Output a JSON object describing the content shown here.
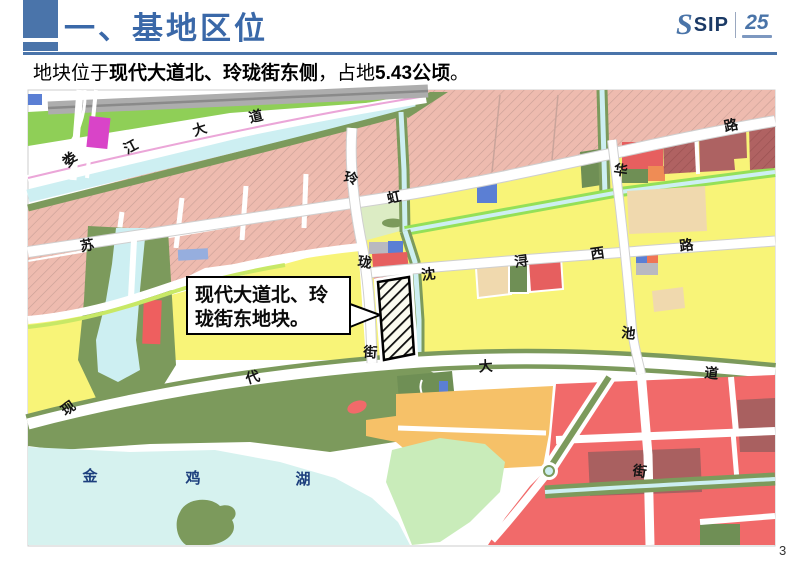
{
  "header": {
    "title": "一、基地区位",
    "logo": {
      "s": "S",
      "text": "SIP",
      "anniversary": "25"
    }
  },
  "subtitle": {
    "prefix": "地块位于",
    "highlight1": "现代大道北、玲珑街东侧",
    "middle": "，占地",
    "highlight2": "5.43公顷",
    "suffix": "。"
  },
  "map": {
    "callout": {
      "line1": "现代大道北、玲",
      "line2": "珑街东地块。"
    },
    "lake": {
      "char1": "金",
      "char2": "鸡",
      "char3": "湖"
    },
    "roads": {
      "loujiang": [
        "娄",
        "江",
        "大",
        "道"
      ],
      "suhong": [
        "苏",
        "虹",
        "路"
      ],
      "linglong": [
        "玲",
        "珑",
        "街"
      ],
      "huachi": [
        "华",
        "池",
        "街"
      ],
      "shenxun": [
        "沈",
        "浔",
        "西",
        "路"
      ],
      "xiandai": [
        "现",
        "代",
        "大",
        "道"
      ]
    },
    "colors": {
      "residential_pink": "#eebbaf",
      "parcel_yellow": "#f8f478",
      "park_green": "#7c9a5c",
      "water_cyan": "#d6f2ef",
      "commercial_red": "#f16a6a",
      "orange": "#f6c168"
    }
  },
  "page_number": "3"
}
